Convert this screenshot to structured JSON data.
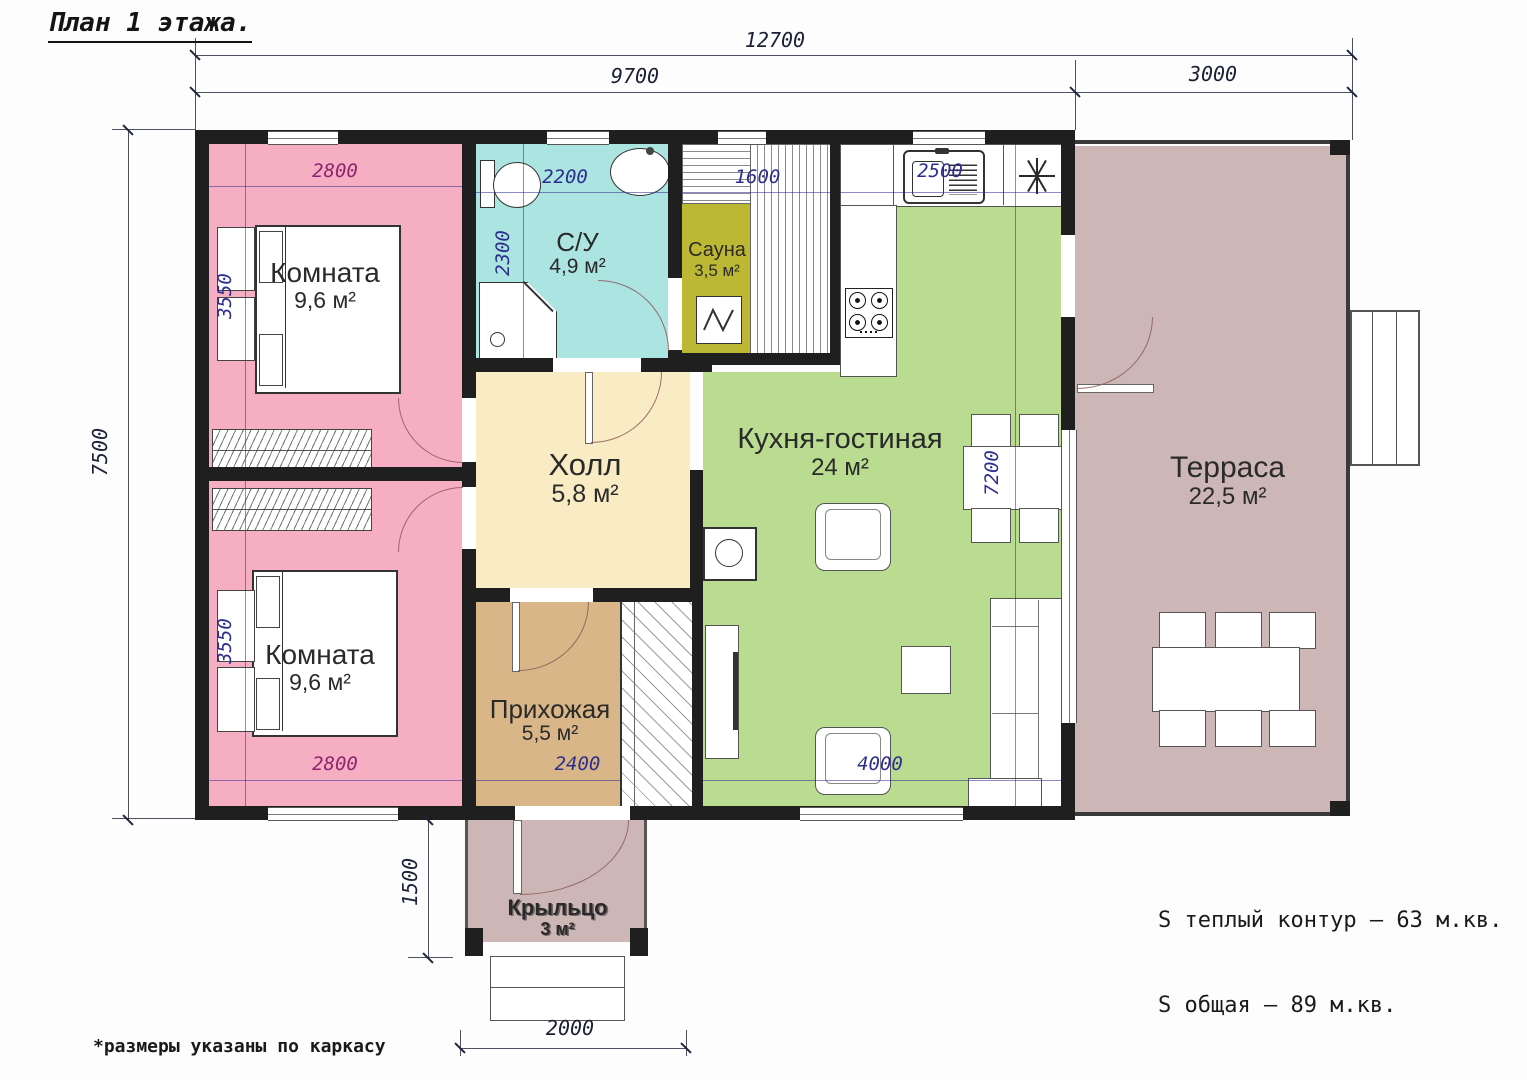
{
  "title": "План 1 этажа.",
  "footnote": "*размеры указаны по каркасу",
  "summary": {
    "warm": "S теплый контур – 63 м.кв.",
    "total": "S общая – 89 м.кв."
  },
  "rooms": {
    "bedroom1": {
      "name": "Комната",
      "area": "9,6 м²"
    },
    "bedroom2": {
      "name": "Комната",
      "area": "9,6 м²"
    },
    "bathroom": {
      "name": "С/У",
      "area": "4,9 м²"
    },
    "sauna": {
      "name": "Сауна",
      "area": "3,5 м²"
    },
    "hall": {
      "name": "Холл",
      "area": "5,8 м²"
    },
    "hallway": {
      "name": "Прихожая",
      "area": "5,5 м²"
    },
    "kitchen_living": {
      "name": "Кухня-гостиная",
      "area": "24 м²"
    },
    "terrace": {
      "name": "Терраса",
      "area": "22,5 м²"
    },
    "porch": {
      "name": "Крыльцо",
      "area": "3 м²"
    }
  },
  "dims": {
    "overall_width": "12700",
    "main_width": "9700",
    "terrace_width": "3000",
    "overall_height": "7500",
    "bedroom1_width": "2800",
    "bedroom1_depth": "3550",
    "bedroom2_width": "2800",
    "bedroom2_depth": "3550",
    "bathroom_width": "2200",
    "bathroom_depth": "2300",
    "sauna_width": "1600",
    "kitchen_width": "2500",
    "living_depth": "7200",
    "living_width": "4000",
    "hallway_width": "2400",
    "porch_depth": "1500",
    "porch_width": "2000"
  },
  "colors": {
    "bedroom": "#f6afc2",
    "bathroom": "#abe4e1",
    "sauna": "#bdb834",
    "hall": "#f9ecc4",
    "hallway": "#d8b687",
    "living": "#b9dc90",
    "terrace": "#cdb6b6",
    "porch": "#cdb6b6",
    "wall": "#1f1f1f",
    "dim": "#2e2e8f",
    "dim_accent": "#8e2470"
  }
}
